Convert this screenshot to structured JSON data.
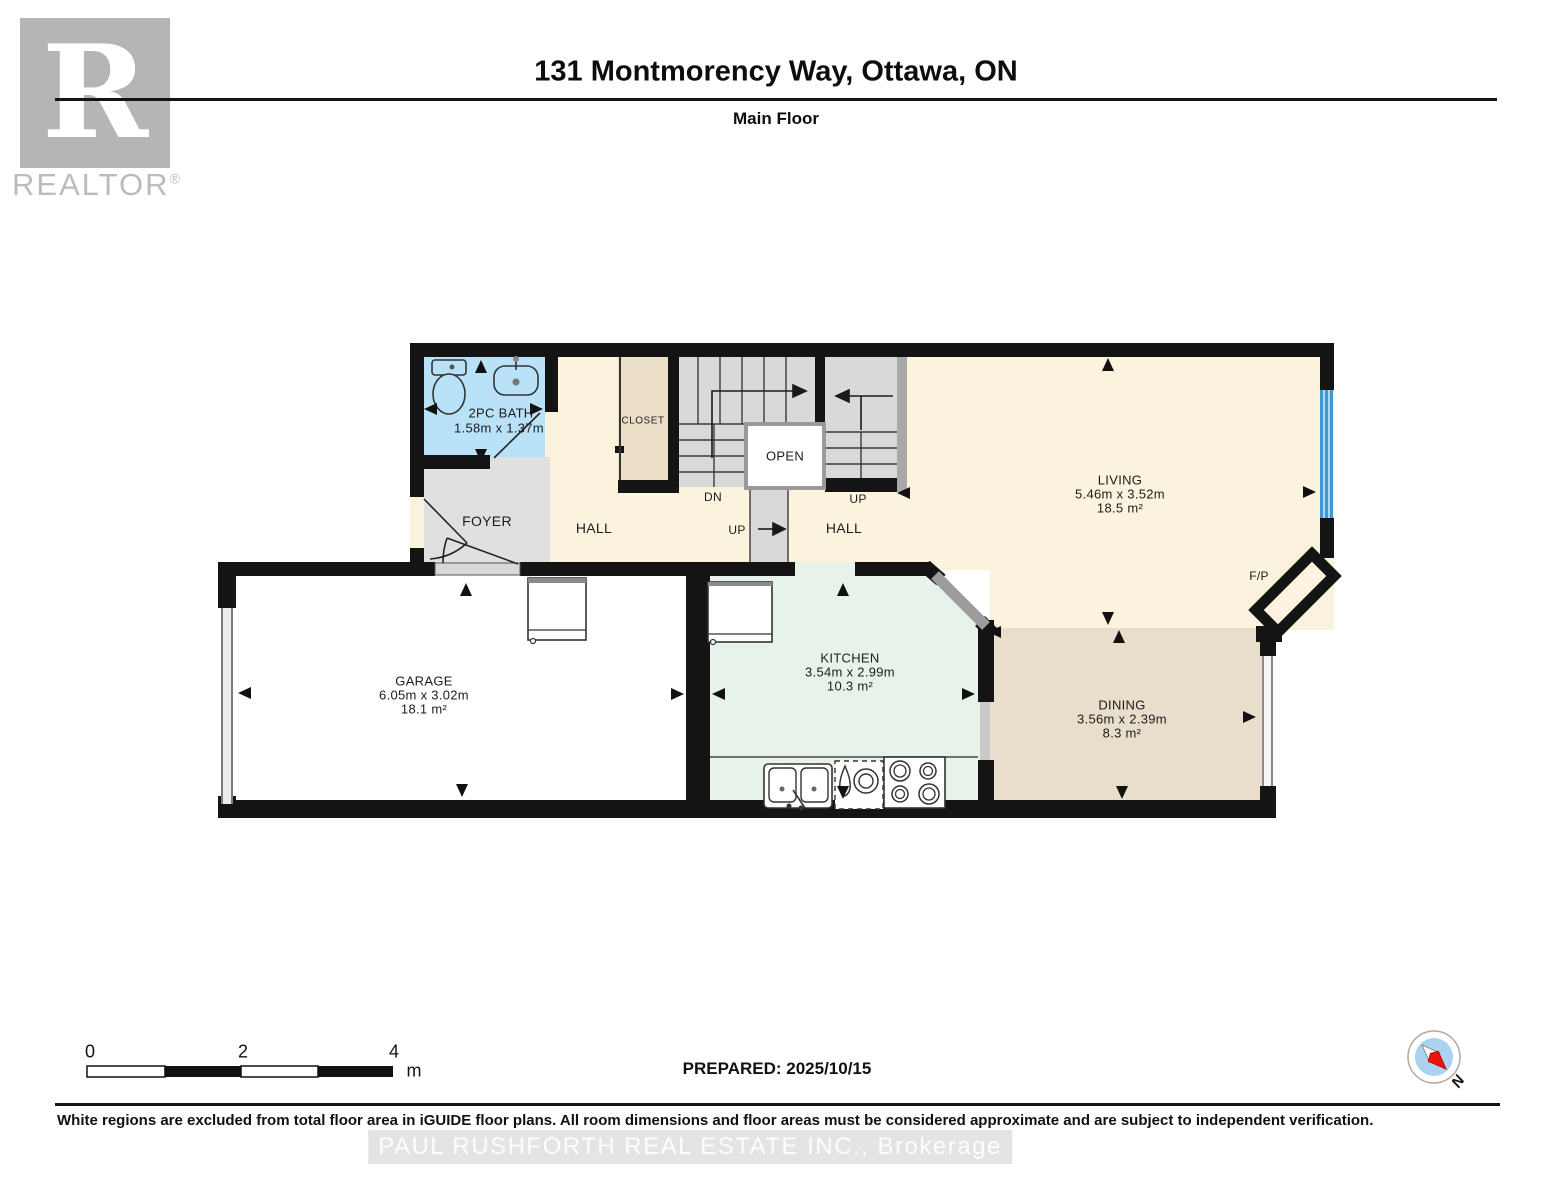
{
  "header": {
    "title": "131 Montmorency Way, Ottawa, ON",
    "subtitle": "Main Floor",
    "logo_letter": "R",
    "logo_word": "REALTOR",
    "logo_registered": "®"
  },
  "rooms": {
    "bath": {
      "name": "2PC BATH",
      "dims": "1.58m x 1.37m"
    },
    "foyer": {
      "name": "FOYER"
    },
    "hall": {
      "name": "HALL"
    },
    "closet": {
      "name": "CLOSET"
    },
    "open": {
      "name": "OPEN"
    },
    "living": {
      "name": "LIVING",
      "dims": "5.46m x 3.52m",
      "area": "18.5 m²"
    },
    "garage": {
      "name": "GARAGE",
      "dims": "6.05m x 3.02m",
      "area": "18.1 m²"
    },
    "kitchen": {
      "name": "KITCHEN",
      "dims": "3.54m x 2.99m",
      "area": "10.3 m²"
    },
    "dining": {
      "name": "DINING",
      "dims": "3.56m x 2.39m",
      "area": "8.3 m²"
    },
    "fireplace": {
      "name": "F/P"
    }
  },
  "stairs": {
    "down": "DN",
    "up": "UP"
  },
  "scale_bar": {
    "tick0": "0",
    "tick2": "2",
    "tick4": "4",
    "unit": "m"
  },
  "prepared_label": "PREPARED: 2025/10/15",
  "compass": {
    "north_label": "N"
  },
  "footer": {
    "disclaimer": "White regions are excluded from total floor area in iGUIDE floor plans. All room dimensions and floor areas must be considered approximate and are subject to independent verification.",
    "watermark": "PAUL RUSHFORTH REAL ESTATE INC., Brokerage"
  },
  "colors": {
    "wall": "#141414",
    "bath_fill": "#b9e2f8",
    "foyer_fill": "#e0e0e0",
    "hall_living_fill": "#fbf3dd",
    "closet_fill": "#ebdfc8",
    "kitchen_fill": "#e7f2eb",
    "dining_fill": "#e8decb",
    "stair_fill": "#d9d9d9",
    "window_blue": "#3f98d2",
    "compass_disc": "#a9d3ee",
    "compass_needle_red": "#e8150e"
  }
}
